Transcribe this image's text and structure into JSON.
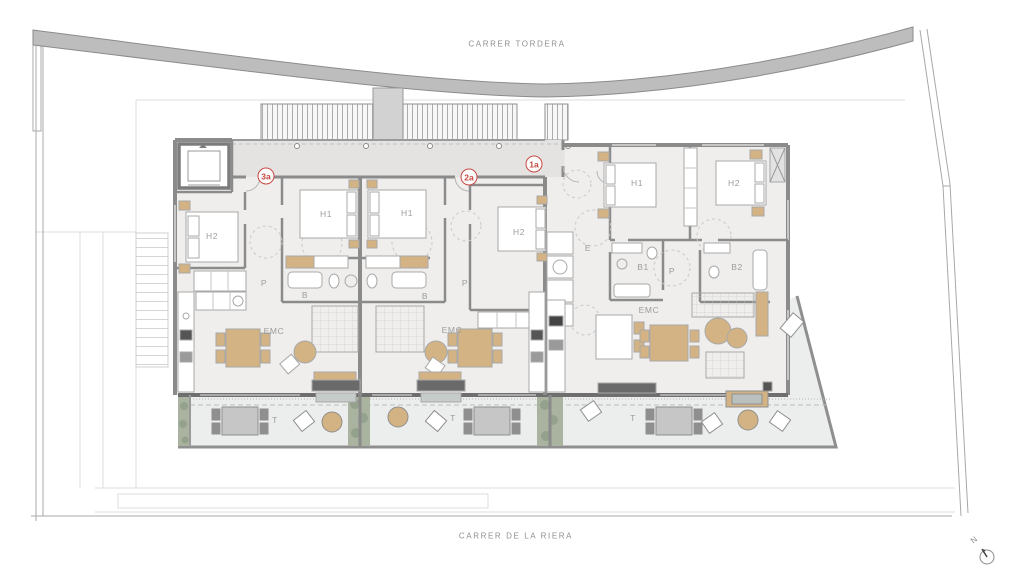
{
  "plan": {
    "streets": {
      "top": "CARRER TORDERA",
      "bottom": "CARRER DE LA RIERA"
    },
    "north_label": "N",
    "unit_badges": [
      {
        "label": "3a",
        "x": 266,
        "y": 176
      },
      {
        "label": "2a",
        "x": 469,
        "y": 177
      },
      {
        "label": "1a",
        "x": 534,
        "y": 164
      }
    ],
    "room_labels": [
      {
        "label": "H2",
        "x": 212,
        "y": 236
      },
      {
        "label": "H1",
        "x": 326,
        "y": 214
      },
      {
        "label": "P",
        "x": 264,
        "y": 283
      },
      {
        "label": "B",
        "x": 305,
        "y": 295
      },
      {
        "label": "EMC",
        "x": 274,
        "y": 331
      },
      {
        "label": "H1",
        "x": 407,
        "y": 213
      },
      {
        "label": "H2",
        "x": 519,
        "y": 232
      },
      {
        "label": "P",
        "x": 465,
        "y": 283
      },
      {
        "label": "B",
        "x": 425,
        "y": 296
      },
      {
        "label": "EMC",
        "x": 452,
        "y": 330
      },
      {
        "label": "H1",
        "x": 637,
        "y": 183
      },
      {
        "label": "H2",
        "x": 734,
        "y": 183
      },
      {
        "label": "E",
        "x": 588,
        "y": 248
      },
      {
        "label": "B1",
        "x": 643,
        "y": 267
      },
      {
        "label": "B2",
        "x": 737,
        "y": 267
      },
      {
        "label": "P",
        "x": 672,
        "y": 271
      },
      {
        "label": "EMC",
        "x": 649,
        "y": 310
      },
      {
        "label": "T",
        "x": 275,
        "y": 420
      },
      {
        "label": "T",
        "x": 453,
        "y": 418
      },
      {
        "label": "T",
        "x": 633,
        "y": 418
      }
    ],
    "colors": {
      "unit_badge": "#c94a45",
      "street_band": "#bdbdbd",
      "wall": "#8b8b8b",
      "facade_dark": "#6e6e6e",
      "floor": "#efeeec",
      "corridor": "#e4e3e1",
      "furniture_tan": "#d3b384",
      "greenery": "#a9b3a0",
      "label_text": "#9c9c9c"
    }
  }
}
